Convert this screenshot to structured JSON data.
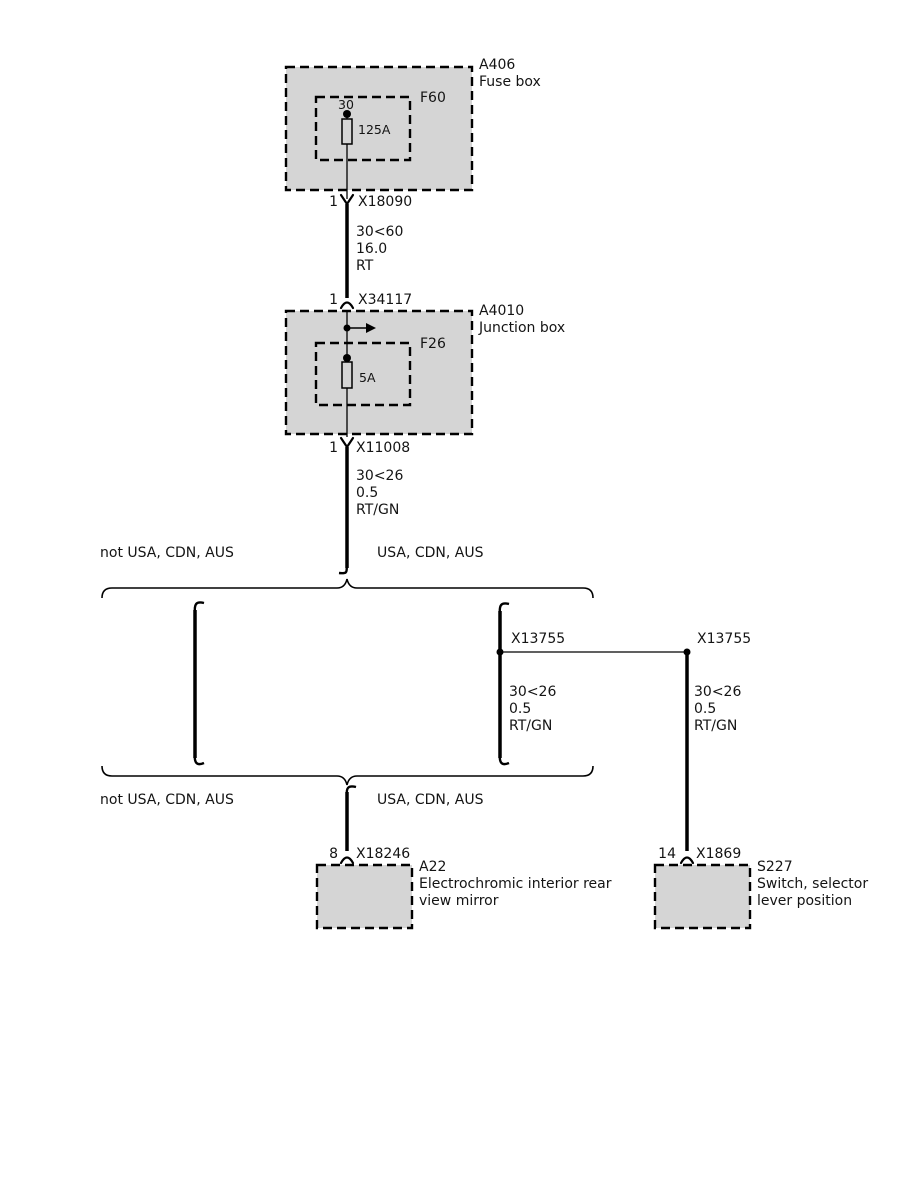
{
  "colors": {
    "box_fill": "#d5d5d5",
    "fuse_fill": "#d5d5d5",
    "line": "#000000"
  },
  "fuse_box": {
    "id": "A406",
    "name": "Fuse box",
    "fuse_label": "F60",
    "terminal": "30",
    "fuse_rating": "125A",
    "out_pin": "1",
    "out_connector": "X18090"
  },
  "wire_fusebox_to_junction": {
    "circuit": "30<60",
    "cross_section": "16.0",
    "color_code": "RT"
  },
  "junction_box": {
    "id": "A4010",
    "name": "Junction box",
    "in_pin": "1",
    "in_connector": "X34117",
    "fuse_label": "F26",
    "fuse_rating": "5A",
    "out_pin": "1",
    "out_connector": "X11008"
  },
  "wire_junction_to_split": {
    "circuit": "30<26",
    "cross_section": "0.5",
    "color_code": "RT/GN"
  },
  "split_top": {
    "left_variant": "not USA, CDN, AUS",
    "right_variant": "USA, CDN, AUS"
  },
  "usa_branch": {
    "connector_left": "X13755",
    "connector_right": "X13755",
    "wire_down": {
      "circuit": "30<26",
      "cross_section": "0.5",
      "color_code": "RT/GN"
    },
    "wire_lateral": {
      "circuit": "30<26",
      "cross_section": "0.5",
      "color_code": "RT/GN"
    }
  },
  "split_bottom": {
    "left_variant": "not USA, CDN, AUS",
    "right_variant": "USA, CDN, AUS"
  },
  "mirror": {
    "pin": "8",
    "connector": "X18246",
    "id": "A22",
    "name": "Electrochromic interior rear view mirror"
  },
  "selector_switch": {
    "pin": "14",
    "connector": "X1869",
    "id": "S227",
    "name": "Switch, selector lever position"
  }
}
